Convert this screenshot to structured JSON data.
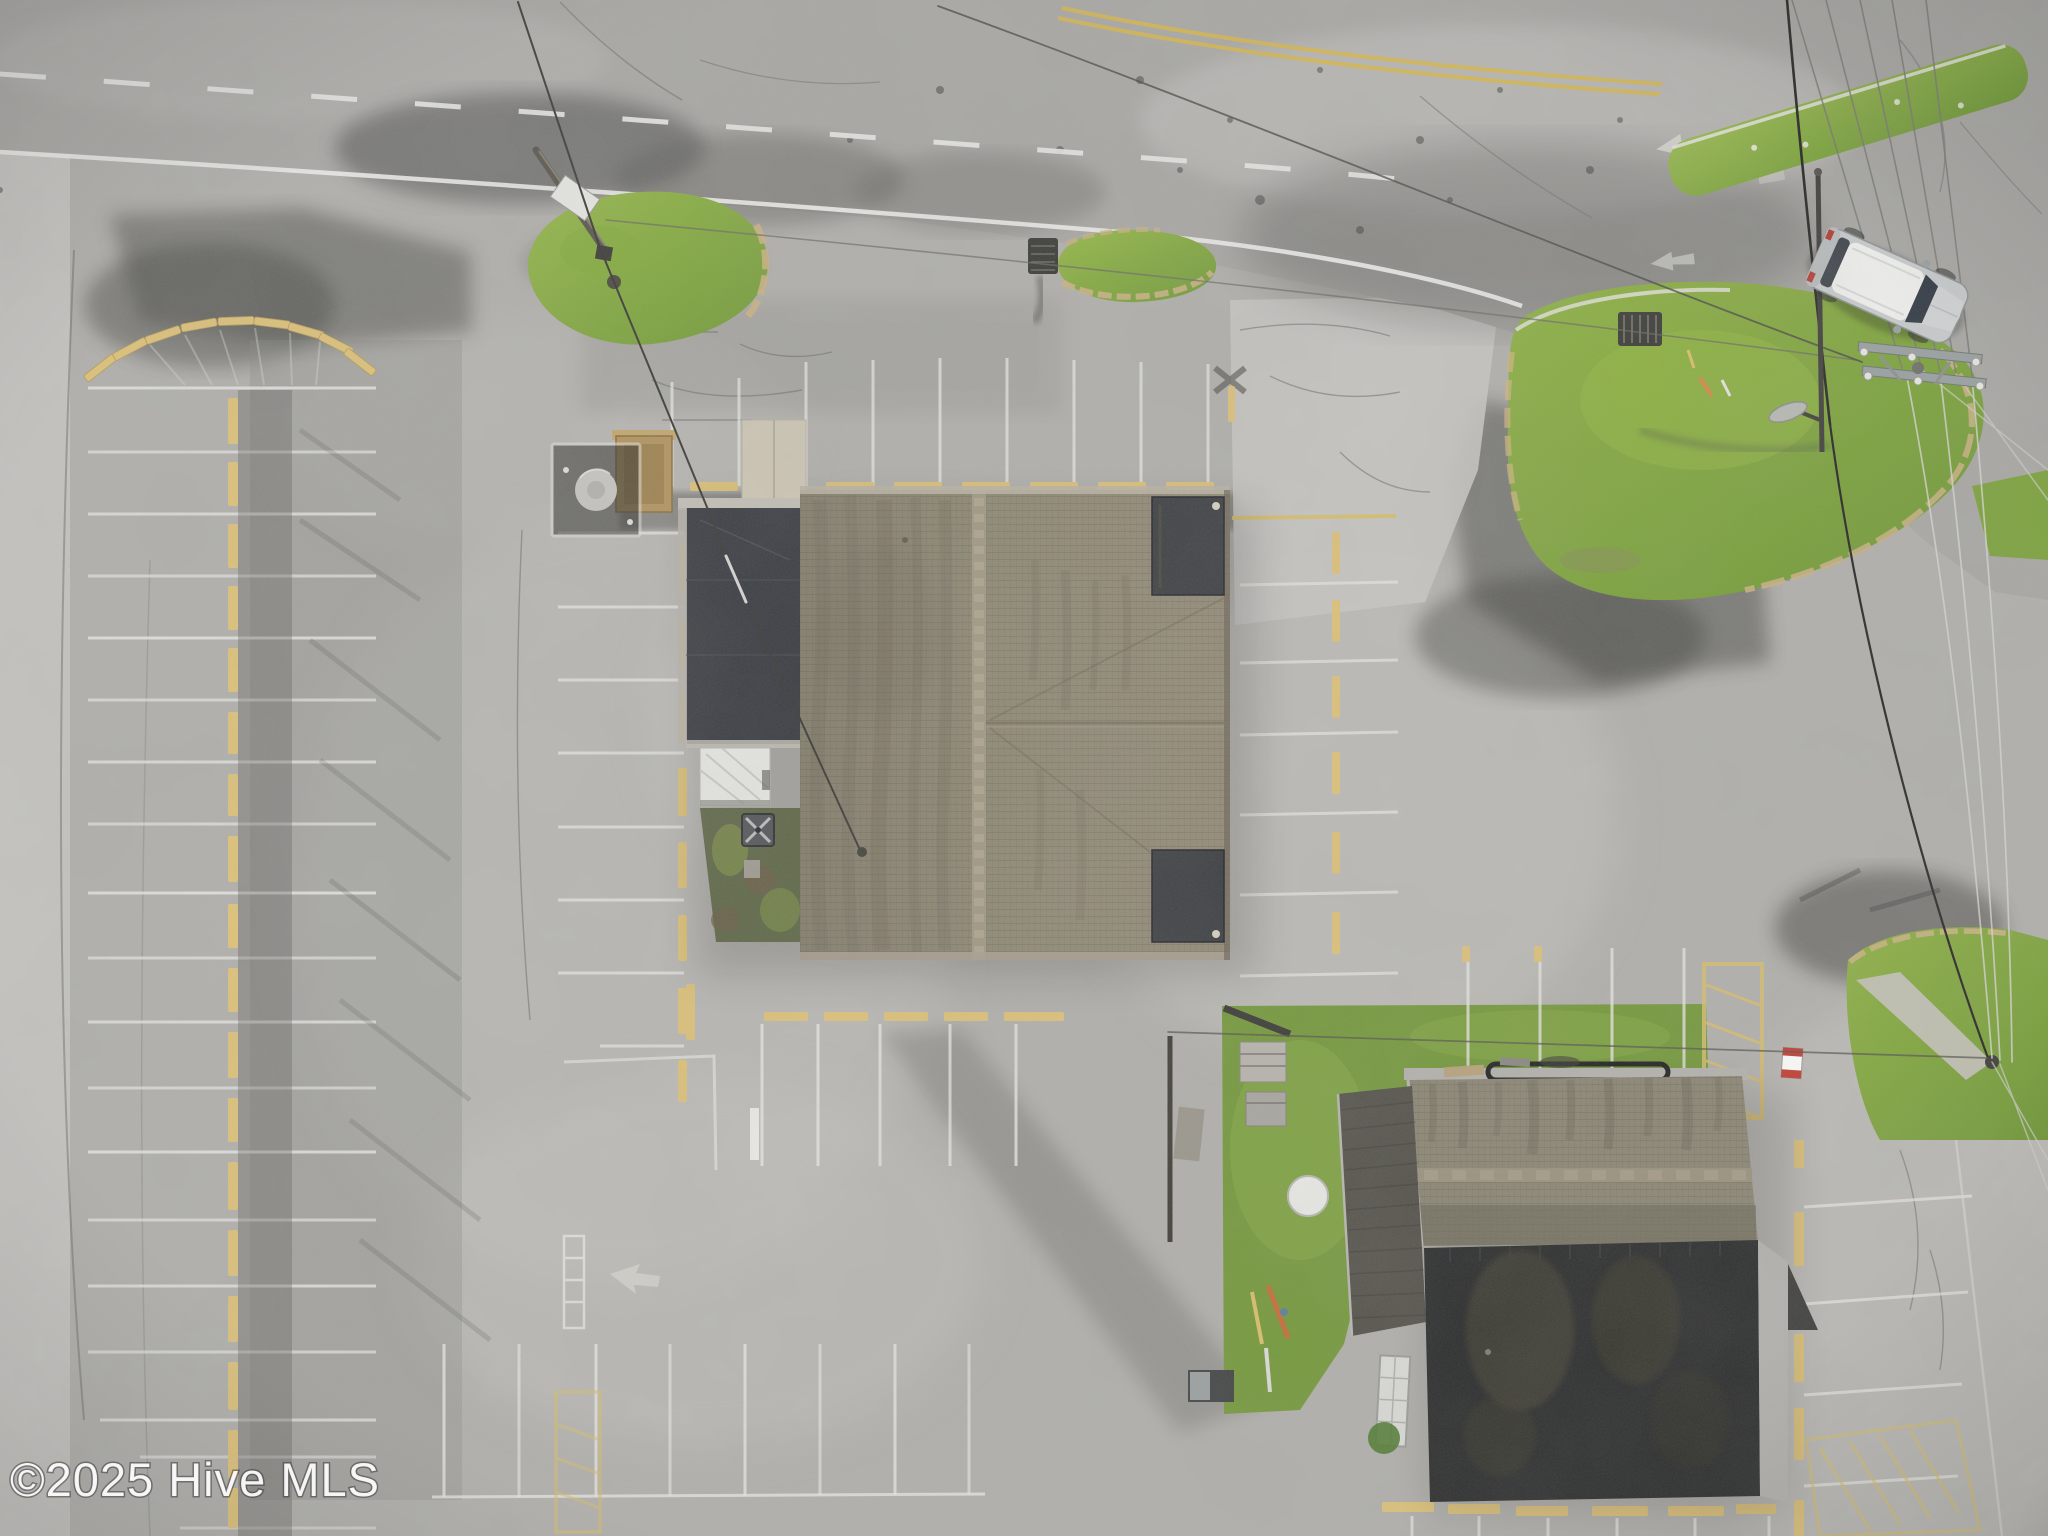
{
  "page": {
    "title": "Aerial drone photograph of commercial property"
  },
  "watermark": {
    "text": "©2025 Hive MLS",
    "color": "#ffffff"
  },
  "scene": {
    "type": "aerial-drone-photograph",
    "view": "top-down nadir view",
    "description": "Weathered vacant commercial parking lot. Two-lane road across the top with white dashed centerline, solid white fog line and a double yellow line curving at the upper right intersection. Center: large building with tan-brown hip shingle roof, black flat roof section at its northwest corner, white tarp shed and weedy yard on its west side. Lower right: second building with gable shingle roof over a large black flat roof, bordered by lawn. Several grass islands, faded white parking stripes, pale yellow wheel stops, overhead power lines, a streetlight, a lattice crossarm utility pole, and a white SUV parked on the road shoulder at upper right.",
    "objects": [
      {
        "name": "two-lane-road",
        "position": "top",
        "markings": "white dashed centerline, solid white fog line, double yellow curve, worn white turn arrows"
      },
      {
        "name": "white-suv",
        "position": "upper-right road shoulder",
        "body_color": "#c9ccce",
        "roof_color": "#f2f3f1"
      },
      {
        "name": "main-building",
        "position": "center",
        "roof": "tan-brown hip shingle roof with two dark rooftop panels and black flat-roof northwest section"
      },
      {
        "name": "secondary-building",
        "position": "lower right",
        "roof": "gable shingle roof over large black flat roof with gray east fascia"
      },
      {
        "name": "grass-island-with-leaning-pole-and-sign",
        "position": "upper left-center"
      },
      {
        "name": "small-grass-island-with-storm-drain",
        "position": "top center"
      },
      {
        "name": "large-grass-island-with-storm-drain-and-markers",
        "position": "upper right"
      },
      {
        "name": "grass-median-strip",
        "position": "top right"
      },
      {
        "name": "grass-patch-with-gravel-path-and-guy-anchor",
        "position": "right edge"
      },
      {
        "name": "lawn-with-round-table-and-sticks",
        "position": "west of secondary building"
      },
      {
        "name": "left-parking-rows",
        "details": "arc of yellow wheel stops at top, horizontal white stall lines, central column of yellow wheel stops"
      },
      {
        "name": "parking-stripe-groups",
        "details": "north of building, west of building, east of building, below building, bottom center, bottom right with yellow hatch zone"
      },
      {
        "name": "overhead-power-lines",
        "position": "top right to lower right"
      },
      {
        "name": "streetlight-pole",
        "position": "right"
      },
      {
        "name": "lattice-crossarm-utility-pole",
        "position": "right"
      },
      {
        "name": "round-tank-in-fenced-pad",
        "position": "left of main building"
      },
      {
        "name": "plywood-enclosure",
        "position": "left of main building"
      },
      {
        "name": "white-tarp-shed",
        "position": "southwest of main building"
      },
      {
        "name": "rooftop-ac-unit-in-weedy-yard",
        "position": "south of shed"
      },
      {
        "name": "red-and-white-cooler",
        "position": "northeast of secondary building"
      },
      {
        "name": "pallet-stack-and-fence",
        "position": "west of secondary building lawn"
      }
    ],
    "palette": {
      "asphalt": "#b1b0ac",
      "asphalt_dark_stain": "#3c3c3a",
      "concrete_light": "#c9c8c4",
      "grass": "#7ca23b",
      "grass_light": "#97b94b",
      "shingle_roof": "#8e8874",
      "flat_roof_black": "#28292a",
      "charcoal_roof": "#514f48",
      "wheel_stop_yellow": "#dfc379",
      "curb_tan": "#cbb283",
      "paint_white": "#e9e9e7",
      "road_yellow": "#d9b84a"
    }
  }
}
